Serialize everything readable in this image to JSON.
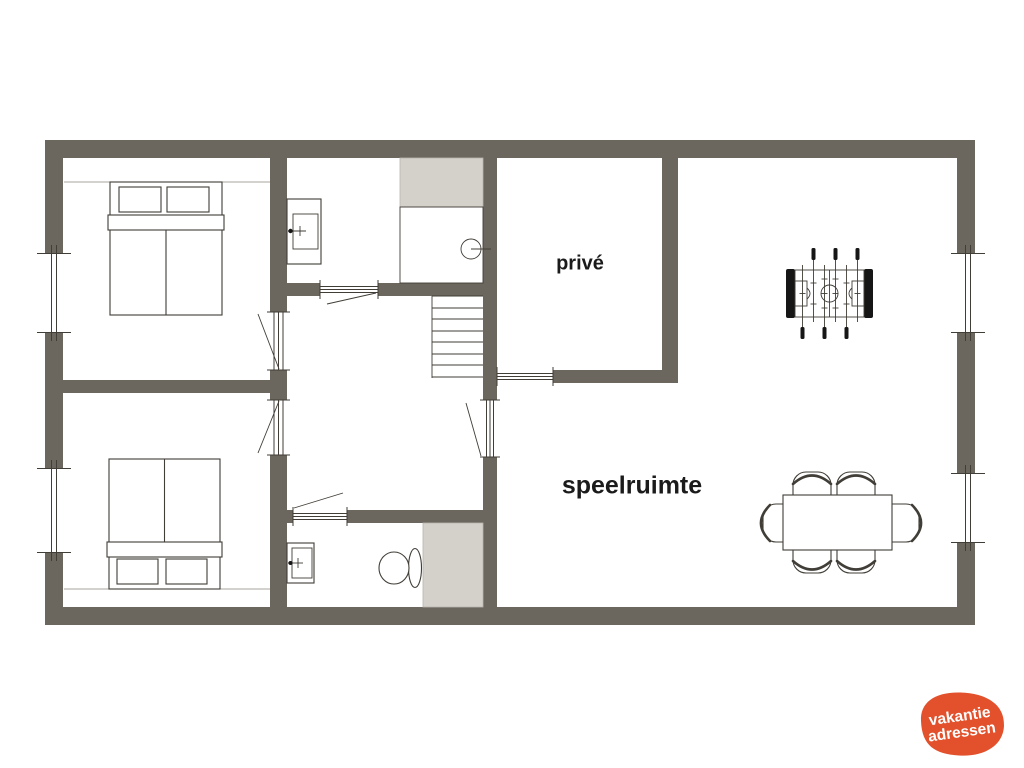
{
  "colors": {
    "background": "#ffffff",
    "wall": "#6b665e",
    "outline": "#413d37",
    "thin_line": "#a9a69f",
    "shading": "#d3d1c9",
    "label_text": "#1b1b1b",
    "logo_orange": "#e2512b",
    "logo_text": "#ffffff"
  },
  "labels": {
    "prive_room": "privé",
    "play_room": "speelruimte"
  },
  "logo": {
    "line1": "vakantie",
    "line2": "adressen"
  },
  "furniture": {
    "bed_top": "double-bed",
    "bed_bottom": "double-bed",
    "sink_top": "washbasin",
    "sink_bottom": "washbasin",
    "toilet": "toilet",
    "shower": "shower-cabin",
    "stairs": "staircase",
    "foosball": "foosball-table",
    "dining_set": "dining-table-with-six-chairs"
  }
}
